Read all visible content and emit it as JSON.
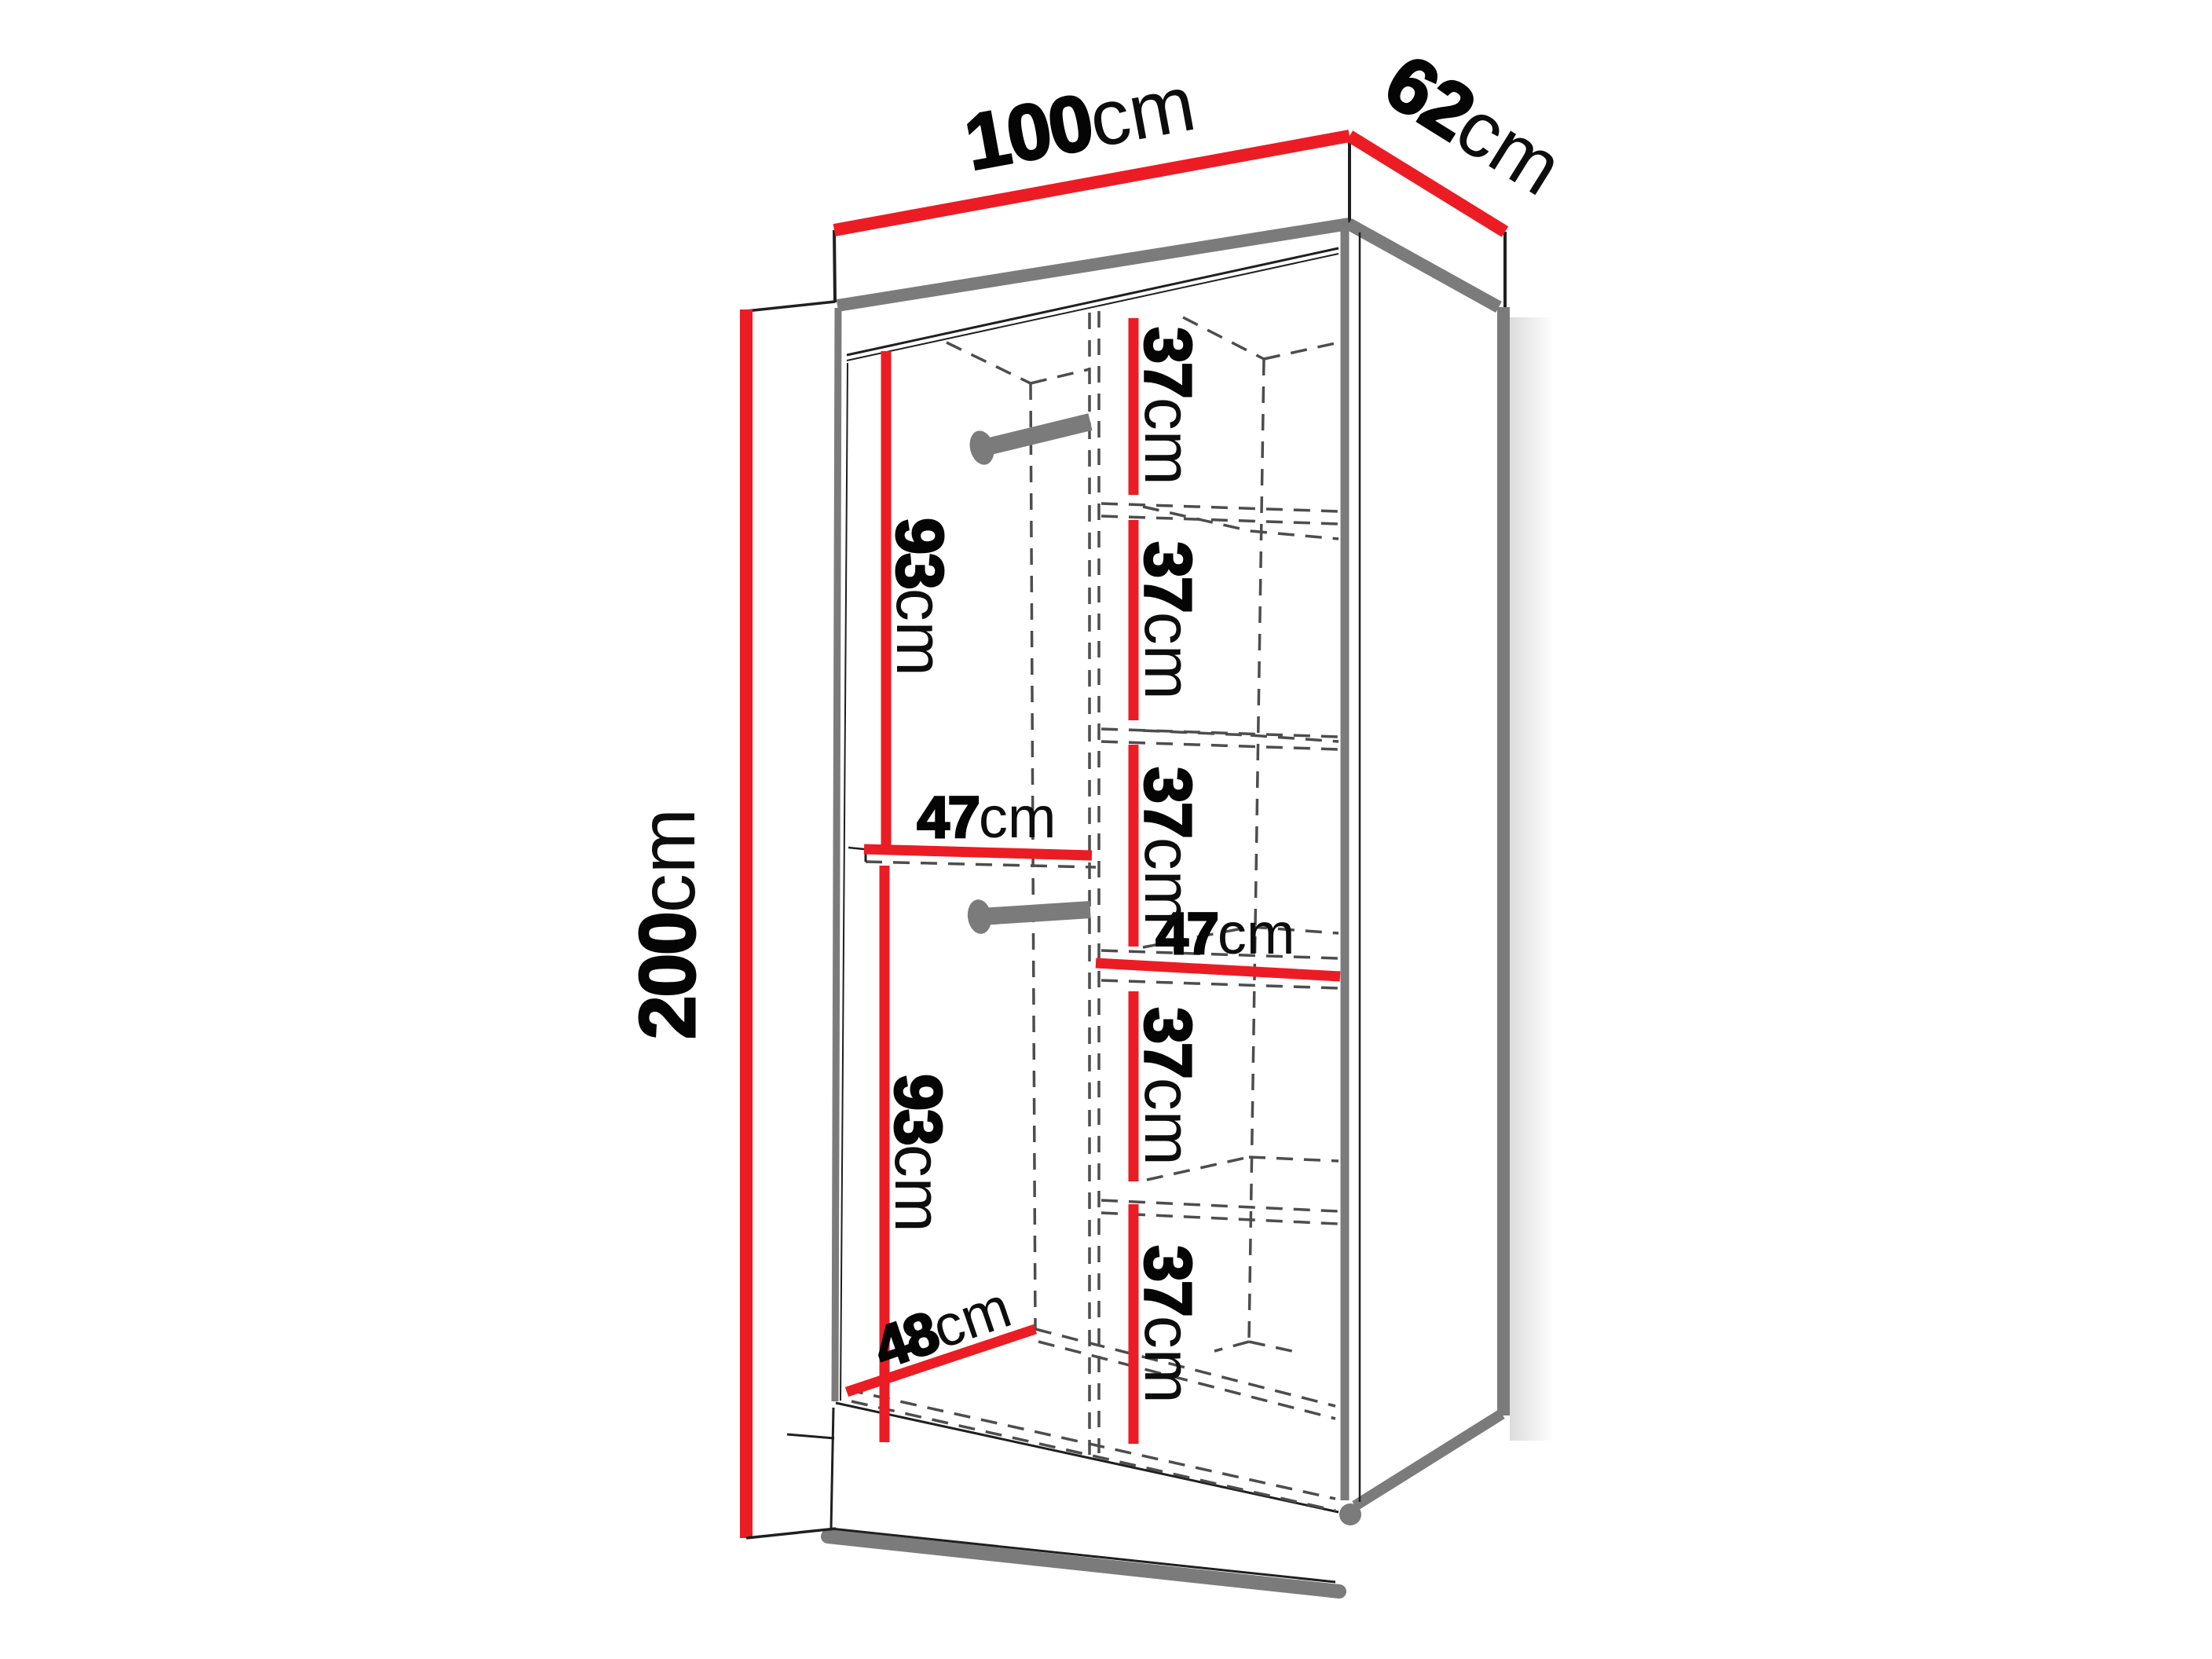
{
  "diagram": {
    "type": "furniture-dimension-diagram",
    "subject": "two-door wardrobe with hanging rails and shelf column"
  },
  "colors": {
    "dimension_red": "#EC1C24",
    "structure_gray": "#7B7B7B",
    "line_black": "#1F1F1F",
    "background": "#FFFFFF"
  },
  "dimensions": {
    "width": {
      "value": "100",
      "unit": "cm"
    },
    "depth": {
      "value": "62",
      "unit": "cm"
    },
    "height": {
      "value": "200",
      "unit": "cm"
    },
    "upper_hanging": {
      "value": "93",
      "unit": "cm"
    },
    "lower_hanging": {
      "value": "93",
      "unit": "cm"
    },
    "left_compartment_width": {
      "value": "47",
      "unit": "cm"
    },
    "right_compartment_width": {
      "value": "47",
      "unit": "cm"
    },
    "interior_depth": {
      "value": "48",
      "unit": "cm"
    },
    "shelf_gaps": [
      {
        "value": "37",
        "unit": "cm"
      },
      {
        "value": "37",
        "unit": "cm"
      },
      {
        "value": "37",
        "unit": "cm"
      },
      {
        "value": "37",
        "unit": "cm"
      },
      {
        "value": "37",
        "unit": "cm"
      }
    ]
  }
}
